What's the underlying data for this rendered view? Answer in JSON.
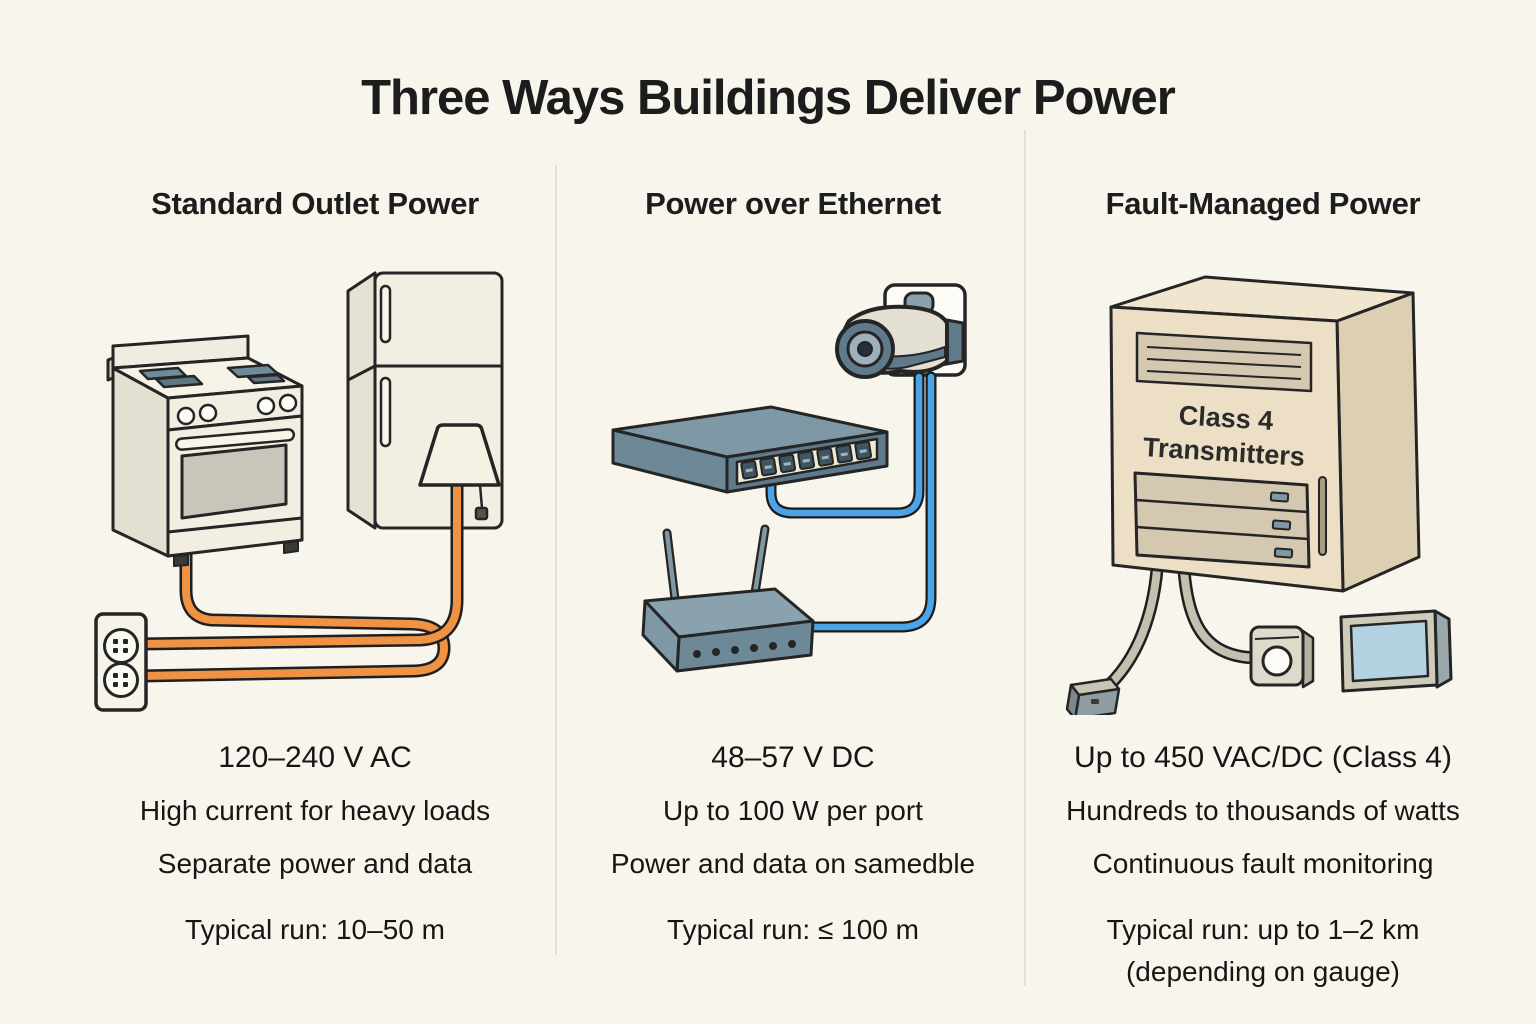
{
  "title": "Three Ways Buildings Deliver Power",
  "colors": {
    "background": "#F8F5EC",
    "text": "#1C1C1C",
    "divider": "#E3E0D7",
    "power_cord_orange": "#F09243",
    "ethernet_blue": "#4DA3E8",
    "cabinet_tan": "#ECDFC6",
    "device_slate": "#6D8896",
    "screen_blue": "#B5D2E2"
  },
  "columns": [
    {
      "header": "Standard Outlet Power",
      "stats": [
        "120–240 V AC",
        "High current for heavy loads",
        "Separate power and data",
        "Typical run: 10–50 m"
      ]
    },
    {
      "header": "Power over Ethernet",
      "stats": [
        "48–57 V DC",
        "Up to 100 W per port",
        "Power and data on samedble",
        "Typical run: ≤ 100 m"
      ]
    },
    {
      "header": "Fault-Managed Power",
      "cabinet_label_line1": "Class 4",
      "cabinet_label_line2": "Transmitters",
      "stats": [
        "Up to 450 VAC/DC (Class 4)",
        "Hundreds to thousands of watts",
        "Continuous fault monitoring",
        "Typical run: up to 1–2 km",
        "(depending on gauge)"
      ]
    }
  ]
}
